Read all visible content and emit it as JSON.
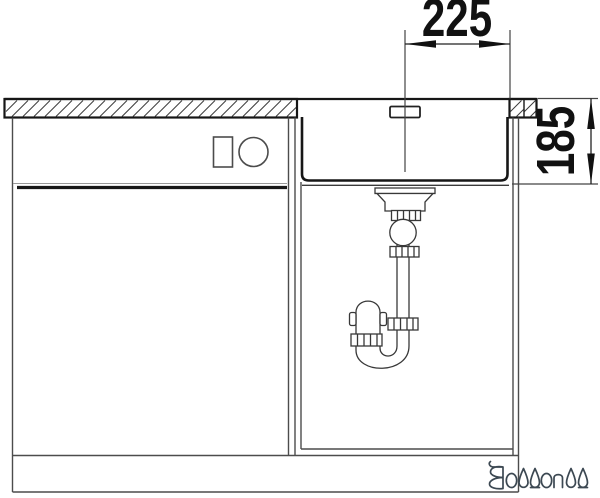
{
  "drawing": {
    "type": "sink-installation-section-diagram",
    "dimension_top": "225",
    "dimension_right": "185",
    "brand": "BLANCO"
  },
  "colors": {
    "line_dark": "#161616",
    "line_medium": "#3a3a3a",
    "line_light": "#4c4c4c",
    "logo": "#3c4852",
    "background": "#ffffff"
  }
}
